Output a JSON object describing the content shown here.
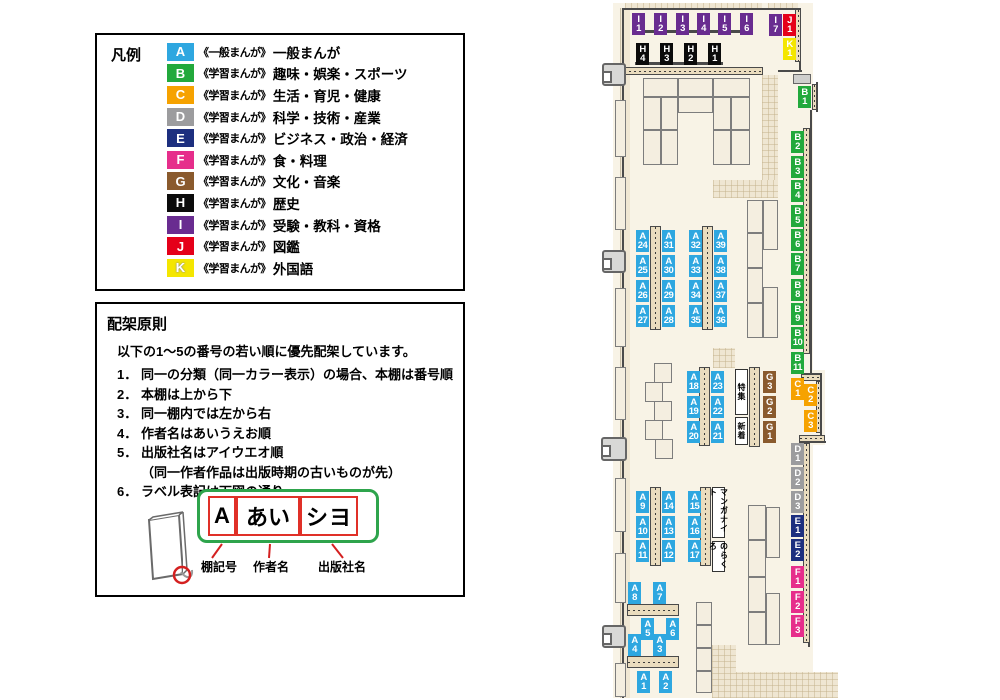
{
  "colors": {
    "A": "#2ea7e0",
    "B": "#22a93c",
    "C": "#f6a200",
    "D": "#9c9c9e",
    "E": "#1d2f7f",
    "F": "#e62e8b",
    "G": "#8a5a2d",
    "H": "#0b0b0b",
    "I": "#692c90",
    "J": "#e50019",
    "K": "#f4e600"
  },
  "legend": {
    "title": "凡例",
    "items": [
      {
        "code": "A",
        "series": "《一般まんが》",
        "category": "一般まんが"
      },
      {
        "code": "B",
        "series": "《学習まんが》",
        "category": "趣味・娯楽・スポーツ"
      },
      {
        "code": "C",
        "series": "《学習まんが》",
        "category": "生活・育児・健康"
      },
      {
        "code": "D",
        "series": "《学習まんが》",
        "category": "科学・技術・産業"
      },
      {
        "code": "E",
        "series": "《学習まんが》",
        "category": "ビジネス・政治・経済"
      },
      {
        "code": "F",
        "series": "《学習まんが》",
        "category": "食・料理"
      },
      {
        "code": "G",
        "series": "《学習まんが》",
        "category": "文化・音楽"
      },
      {
        "code": "H",
        "series": "《学習まんが》",
        "category": "歴史"
      },
      {
        "code": "I",
        "series": "《学習まんが》",
        "category": "受験・教科・資格"
      },
      {
        "code": "J",
        "series": "《学習まんが》",
        "category": "図鑑"
      },
      {
        "code": "K",
        "series": "《学習まんが》",
        "category": "外国語"
      }
    ]
  },
  "principles": {
    "title": "配架原則",
    "intro": "以下の1～5の番号の若い順に優先配架しています。",
    "rules": [
      {
        "num": "1．",
        "text": "同一の分類（同一カラー表示）の場合、本棚は番号順"
      },
      {
        "num": "2．",
        "text": "本棚は上から下"
      },
      {
        "num": "3．",
        "text": "同一棚内では左から右"
      },
      {
        "num": "4．",
        "text": "作者名はあいうえお順"
      },
      {
        "num": "5．",
        "text": "出版社名はアイウエオ順"
      },
      {
        "num": "",
        "text": "（同一作者作品は出版時期の古いものが先）"
      },
      {
        "num": "6．",
        "text": "ラベル表記は下図の通り"
      }
    ],
    "label_example": {
      "shelf": "A",
      "author": "あい",
      "publisher": "シヨ"
    },
    "label_captions": [
      "棚記号",
      "作者名",
      "出版社名"
    ]
  },
  "map": {
    "labels": [
      {
        "code": "I1",
        "x": 632,
        "y": 13
      },
      {
        "code": "I2",
        "x": 654,
        "y": 13
      },
      {
        "code": "I3",
        "x": 676,
        "y": 13
      },
      {
        "code": "I4",
        "x": 697,
        "y": 13
      },
      {
        "code": "I5",
        "x": 718,
        "y": 13
      },
      {
        "code": "I6",
        "x": 740,
        "y": 13
      },
      {
        "code": "I7",
        "x": 769,
        "y": 14
      },
      {
        "code": "J1",
        "x": 783,
        "y": 14
      },
      {
        "code": "K1",
        "x": 783,
        "y": 38
      },
      {
        "code": "H4",
        "x": 636,
        "y": 43
      },
      {
        "code": "H3",
        "x": 660,
        "y": 43
      },
      {
        "code": "H2",
        "x": 684,
        "y": 43
      },
      {
        "code": "H1",
        "x": 708,
        "y": 43
      },
      {
        "code": "B1",
        "x": 798,
        "y": 86
      },
      {
        "code": "B2",
        "x": 791,
        "y": 131
      },
      {
        "code": "B3",
        "x": 791,
        "y": 156
      },
      {
        "code": "B4",
        "x": 791,
        "y": 180
      },
      {
        "code": "B5",
        "x": 791,
        "y": 205
      },
      {
        "code": "B6",
        "x": 791,
        "y": 229
      },
      {
        "code": "B7",
        "x": 791,
        "y": 253
      },
      {
        "code": "B8",
        "x": 791,
        "y": 279
      },
      {
        "code": "B9",
        "x": 791,
        "y": 303
      },
      {
        "code": "B10",
        "x": 791,
        "y": 327
      },
      {
        "code": "B11",
        "x": 791,
        "y": 352
      },
      {
        "code": "C1",
        "x": 791,
        "y": 378
      },
      {
        "code": "C2",
        "x": 804,
        "y": 384
      },
      {
        "code": "C3",
        "x": 804,
        "y": 410
      },
      {
        "code": "D1",
        "x": 791,
        "y": 443
      },
      {
        "code": "D2",
        "x": 791,
        "y": 467
      },
      {
        "code": "D3",
        "x": 791,
        "y": 491
      },
      {
        "code": "E1",
        "x": 791,
        "y": 515
      },
      {
        "code": "E2",
        "x": 791,
        "y": 539
      },
      {
        "code": "F1",
        "x": 791,
        "y": 566
      },
      {
        "code": "F2",
        "x": 791,
        "y": 591
      },
      {
        "code": "F3",
        "x": 791,
        "y": 615
      },
      {
        "code": "G3",
        "x": 763,
        "y": 371
      },
      {
        "code": "G2",
        "x": 763,
        "y": 396
      },
      {
        "code": "G1",
        "x": 763,
        "y": 421
      },
      {
        "code": "A24",
        "x": 636,
        "y": 230
      },
      {
        "code": "A25",
        "x": 636,
        "y": 255
      },
      {
        "code": "A26",
        "x": 636,
        "y": 280
      },
      {
        "code": "A27",
        "x": 636,
        "y": 305
      },
      {
        "code": "A31",
        "x": 662,
        "y": 230
      },
      {
        "code": "A30",
        "x": 662,
        "y": 255
      },
      {
        "code": "A29",
        "x": 662,
        "y": 280
      },
      {
        "code": "A28",
        "x": 662,
        "y": 305
      },
      {
        "code": "A32",
        "x": 689,
        "y": 230
      },
      {
        "code": "A33",
        "x": 689,
        "y": 255
      },
      {
        "code": "A34",
        "x": 689,
        "y": 280
      },
      {
        "code": "A35",
        "x": 689,
        "y": 305
      },
      {
        "code": "A39",
        "x": 714,
        "y": 230
      },
      {
        "code": "A38",
        "x": 714,
        "y": 255
      },
      {
        "code": "A37",
        "x": 714,
        "y": 280
      },
      {
        "code": "A36",
        "x": 714,
        "y": 305
      },
      {
        "code": "A18",
        "x": 687,
        "y": 371
      },
      {
        "code": "A19",
        "x": 687,
        "y": 396
      },
      {
        "code": "A20",
        "x": 687,
        "y": 421
      },
      {
        "code": "A23",
        "x": 711,
        "y": 371
      },
      {
        "code": "A22",
        "x": 711,
        "y": 396
      },
      {
        "code": "A21",
        "x": 711,
        "y": 421
      },
      {
        "code": "A9",
        "x": 636,
        "y": 491
      },
      {
        "code": "A10",
        "x": 636,
        "y": 516
      },
      {
        "code": "A11",
        "x": 636,
        "y": 540
      },
      {
        "code": "A14",
        "x": 662,
        "y": 491
      },
      {
        "code": "A13",
        "x": 662,
        "y": 516
      },
      {
        "code": "A12",
        "x": 662,
        "y": 540
      },
      {
        "code": "A15",
        "x": 688,
        "y": 491
      },
      {
        "code": "A16",
        "x": 688,
        "y": 516
      },
      {
        "code": "A17",
        "x": 688,
        "y": 540
      },
      {
        "code": "A8",
        "x": 628,
        "y": 582
      },
      {
        "code": "A7",
        "x": 653,
        "y": 582
      },
      {
        "code": "A5",
        "x": 641,
        "y": 618
      },
      {
        "code": "A6",
        "x": 666,
        "y": 618
      },
      {
        "code": "A4",
        "x": 628,
        "y": 634
      },
      {
        "code": "A3",
        "x": 653,
        "y": 634
      },
      {
        "code": "A1",
        "x": 637,
        "y": 671
      },
      {
        "code": "A2",
        "x": 659,
        "y": 671
      }
    ],
    "sections": [
      {
        "name": "tokushu",
        "text": "特集",
        "x": 735,
        "y": 369,
        "w": 13,
        "h": 46
      },
      {
        "name": "shinchaku",
        "text": "新着",
        "x": 735,
        "y": 417,
        "w": 13,
        "h": 28
      },
      {
        "name": "manga-night",
        "text": "マンガナイト",
        "x": 712,
        "y": 487,
        "w": 13,
        "h": 51
      },
      {
        "name": "norakuro",
        "text": "のらくろ",
        "x": 712,
        "y": 541,
        "w": 13,
        "h": 31
      }
    ]
  }
}
